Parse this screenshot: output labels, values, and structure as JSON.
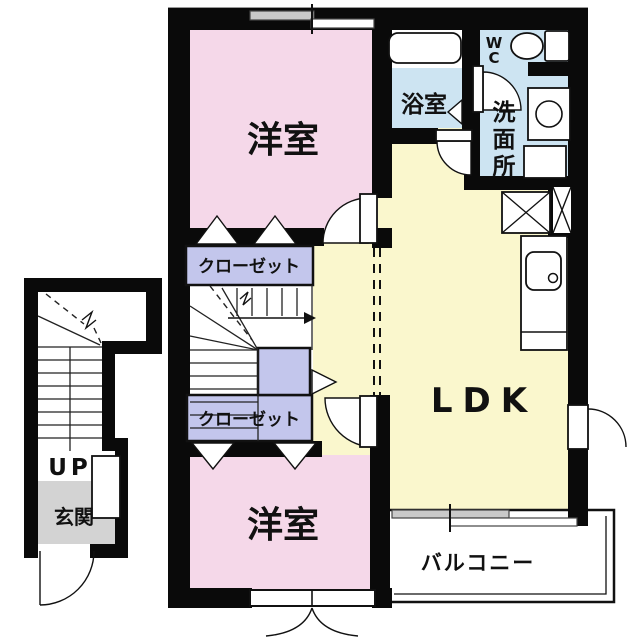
{
  "plan": {
    "title": "apartment-floor-plan",
    "labels": {
      "bedroom_top": "洋室",
      "bedroom_bottom": "洋室",
      "ldk": "LDK",
      "bath": "浴室",
      "wc": [
        "W",
        "C"
      ],
      "washroom": [
        "洗",
        "面",
        "所"
      ],
      "closet_top": "クローゼット",
      "closet_bottom": "クローゼット",
      "balcony": "バルコニー",
      "entrance": "玄関",
      "stairs_up": "UP"
    },
    "colors": {
      "room_pink": "#F5D8E9",
      "closet_lavender": "#C3C6EC",
      "water_blue": "#CDE4F2",
      "ldk_yellow": "#FAF7CD",
      "entrance_gray": "#D3D3D3",
      "wall_black": "#0A0A0A",
      "window_gray": "#C9C9C9"
    }
  }
}
